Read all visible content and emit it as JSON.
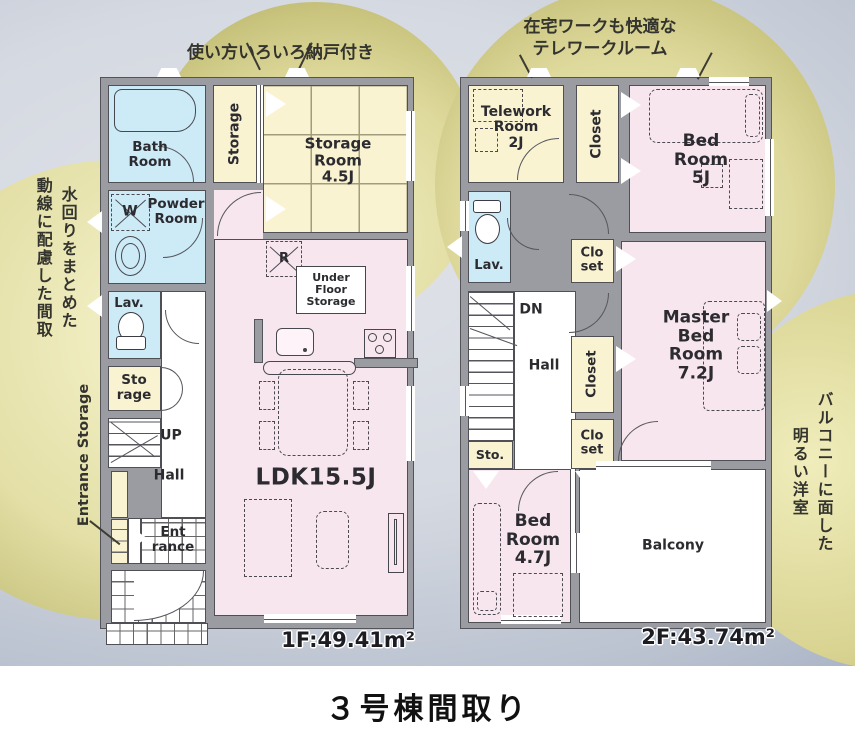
{
  "page": {
    "title": "３号棟間取り"
  },
  "annotations": {
    "storage_note": "使い方いろいろ納戸付き",
    "telework_note": "在宅ワークも快適な\nテレワークルーム",
    "plumbing_note": "水回りをまとめた\n動線に配慮した間取",
    "balcony_note": "バルコニーに面した\n明るい洋室",
    "entrance_storage_label": "Entrance Storage"
  },
  "floor1": {
    "area": "1F:49.41m²",
    "rooms": {
      "bath": "Bath\nRoom",
      "storage_hall": "Storage",
      "storage_room": "Storage\nRoom\n4.5J",
      "washer": "W",
      "powder": "Powder\nRoom",
      "lavatory": "Lav.",
      "storage_small": "Sto\nrage",
      "stairs": "UP",
      "hall": "Hall",
      "entrance": "Ent\nrance",
      "ldk": "LDK15.5J",
      "under_floor_storage": "Under\nFloor\nStorage",
      "refrigerator": "R"
    }
  },
  "floor2": {
    "area": "2F:43.74m²",
    "rooms": {
      "telework": "Telework\nRoom\n2J",
      "closet_north": "Closet",
      "bedroom5": "Bed\nRoom\n5J",
      "lavatory": "Lav.",
      "stairs": "DN",
      "hall": "Hall",
      "closet_a": "Clo\nset",
      "closet_mid": "Closet",
      "closet_b": "Clo\nset",
      "storage": "Sto.",
      "master_bedroom": "Master\nBed\nRoom\n7.2J",
      "bedroom47": "Bed\nRoom\n4.7J",
      "balcony": "Balcony"
    }
  },
  "colors": {
    "room_pink": "#f8e6ee",
    "room_yellow": "#faf3d2",
    "room_blue": "#cdeaf7",
    "wall_gray": "#9b9ca2",
    "blob_olive": "#b2ad5e",
    "background_slate": "#96a2ba"
  }
}
